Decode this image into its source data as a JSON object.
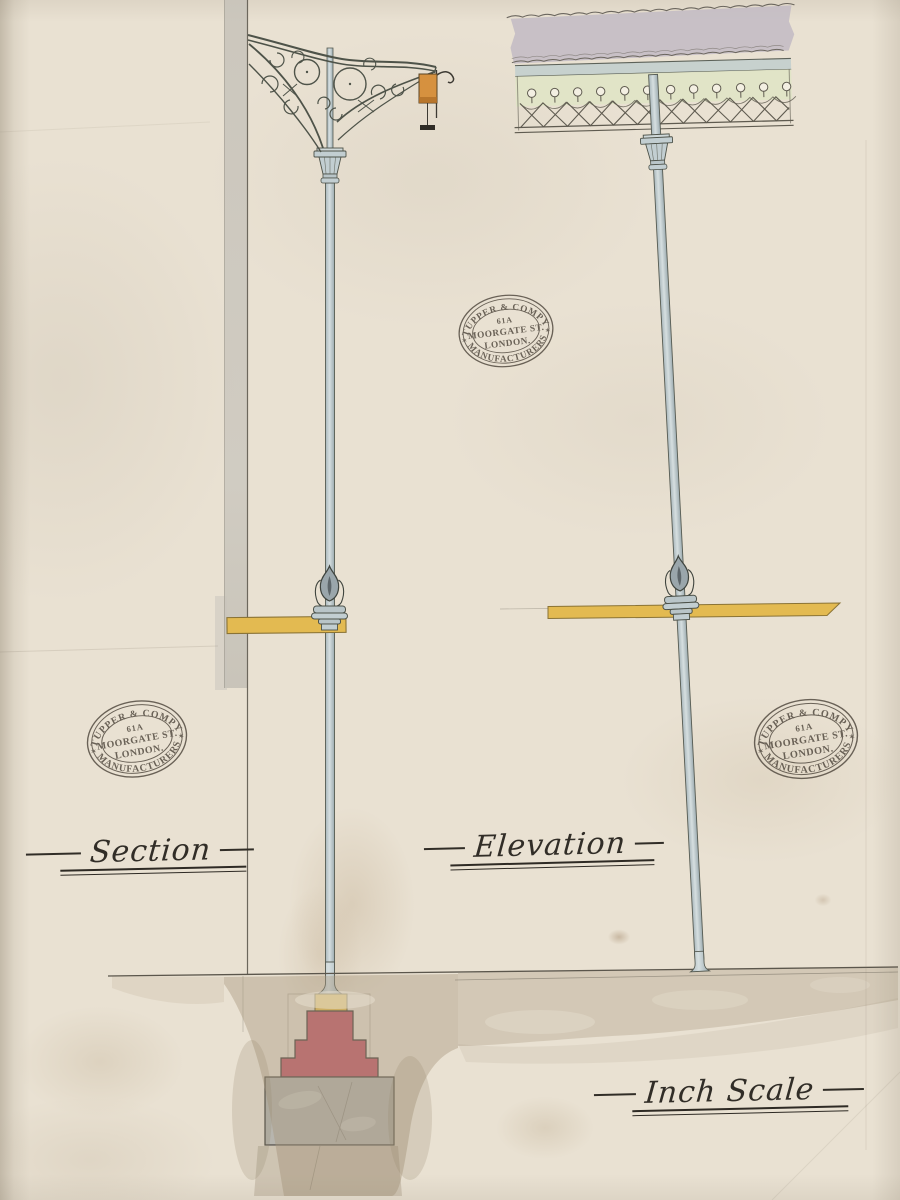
{
  "stamp": {
    "company": "TUPPER & COMPY",
    "number": "61A",
    "street": "MOORGATE ST.",
    "city": "LONDON.",
    "trade": "MANUFACTURERS",
    "star": "✶"
  },
  "labels": {
    "section": "Section",
    "elevation": "Elevation",
    "scale": "Inch Scale"
  },
  "colors": {
    "paper": "#e9e1d2",
    "pole_metal": "#c2cdd0",
    "crossbar_yellow": "#e3ba51",
    "base_red": "#c45b69",
    "foundation_grey": "#b7b5ae",
    "frieze_green": "#e0e4c6",
    "roof_grey": "#c4bdc4",
    "sign_orange": "#d6913f",
    "ground_brown": "#a6957c",
    "ink": "#4e463c"
  }
}
